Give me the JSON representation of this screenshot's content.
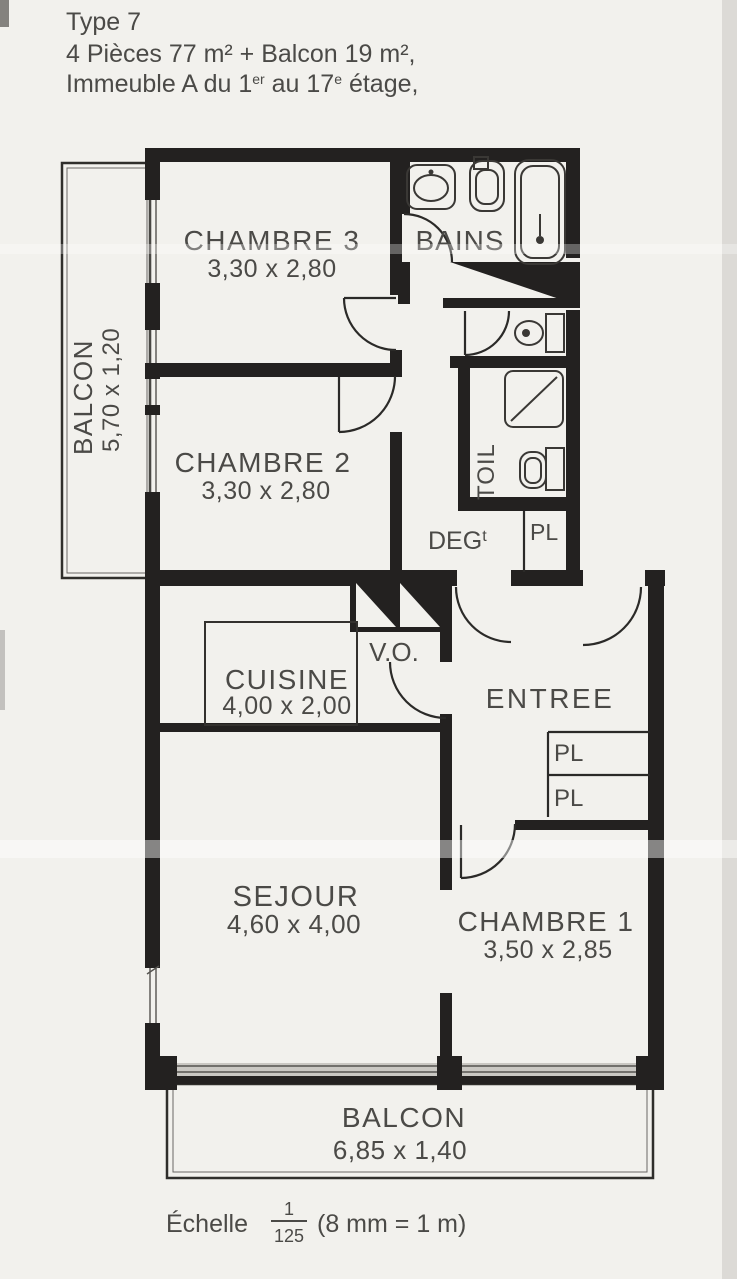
{
  "header": {
    "line1": "Type 7",
    "line2": "4 Pièces 77 m² + Balcon 19 m²,",
    "line3a": "Immeuble A du 1",
    "line3sup1": "er",
    "line3b": " au 17",
    "line3sup2": "e",
    "line3c": " étage,"
  },
  "rooms": {
    "chambre3": {
      "name": "CHAMBRE 3",
      "dims": "3,30 x 2,80"
    },
    "chambre2": {
      "name": "CHAMBRE 2",
      "dims": "3,30 x 2,80"
    },
    "chambre1": {
      "name": "CHAMBRE 1",
      "dims": "3,50 x 2,85"
    },
    "sejour": {
      "name": "SEJOUR",
      "dims": "4,60 x 4,00"
    },
    "cuisine": {
      "name": "CUISINE",
      "dims": "4,00 x 2,00"
    },
    "entree": {
      "name": "ENTREE"
    },
    "bains": {
      "name": "BAINS"
    },
    "toilettes": {
      "name": "TOIL"
    },
    "degagement": {
      "name": "DEG",
      "sup": "t"
    },
    "vide_ordures": {
      "name": "V.O."
    },
    "placard": {
      "name": "PL"
    }
  },
  "balconies": {
    "left": {
      "name": "BALCON",
      "dims": "5,70 x 1,20"
    },
    "bottom": {
      "name": "BALCON",
      "dims": "6,85 x 1,40"
    }
  },
  "scale_note": {
    "label": "Échelle",
    "numerator": "1",
    "denominator": "125",
    "formula": "(8 mm = 1 m)"
  },
  "colors": {
    "paper": "#f2f1ed",
    "wall": "#232120",
    "label": "#4b4a47",
    "glazing": "#cac8c3"
  }
}
